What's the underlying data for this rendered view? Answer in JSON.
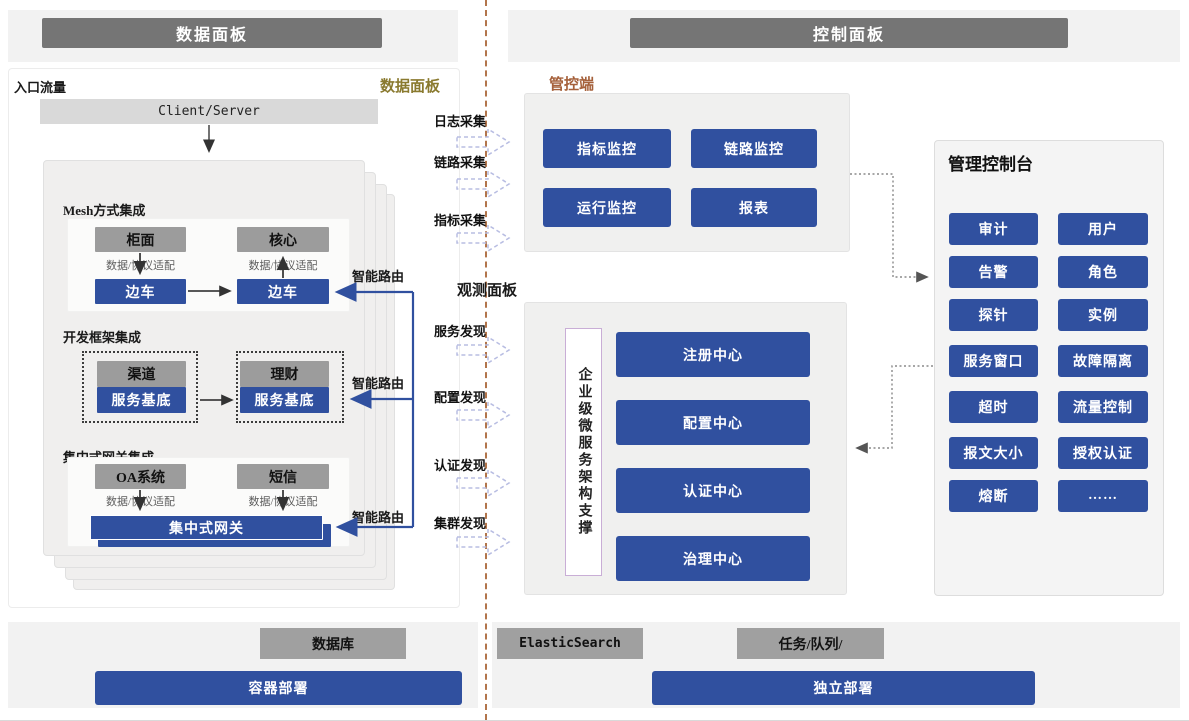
{
  "headers": {
    "left": "数据面板",
    "right": "控制面板"
  },
  "dp": {
    "entry": "入口流量",
    "label": "数据面板",
    "client_server": "Client/Server",
    "adapter": "数据/协议适配",
    "smart_route": "智能路由",
    "mesh": {
      "title": "Mesh方式集成",
      "apps": [
        "柜面",
        "核心"
      ],
      "sidecar": "边车"
    },
    "framework": {
      "title": "开发框架集成",
      "apps": [
        "渠道",
        "理财"
      ],
      "base": "服务基底"
    },
    "gateway": {
      "title": "集中式网关集成",
      "apps": [
        "OA系统",
        "短信"
      ],
      "bar": "集中式网关"
    }
  },
  "flow": {
    "collect": [
      "日志采集",
      "链路采集",
      "指标采集"
    ],
    "observe": "观测面板",
    "discover": [
      "服务发现",
      "配置发现",
      "认证发现",
      "集群发现"
    ]
  },
  "monitor": {
    "label": "管控端",
    "buttons": [
      "指标监控",
      "链路监控",
      "运行监控",
      "报表"
    ]
  },
  "support": {
    "vertical": "企业级微服务架构支撑",
    "centers": [
      "注册中心",
      "配置中心",
      "认证中心",
      "治理中心"
    ]
  },
  "console": {
    "title": "管理控制台",
    "buttons": [
      "审计",
      "用户",
      "告警",
      "角色",
      "探针",
      "实例",
      "服务窗口",
      "故障隔离",
      "超时",
      "流量控制",
      "报文大小",
      "授权认证",
      "熔断",
      "……"
    ]
  },
  "footer": {
    "db": "数据库",
    "container_deploy": "容器部署",
    "es": "ElasticSearch",
    "queue": "任务/队列/",
    "standalone_deploy": "独立部署"
  },
  "colors": {
    "accent": "#30509f",
    "gray_box": "#9c9c9c",
    "header_bar": "#757575",
    "olive": "#8a7a2f",
    "brown": "#a5603a",
    "divider": "#b2754b"
  }
}
